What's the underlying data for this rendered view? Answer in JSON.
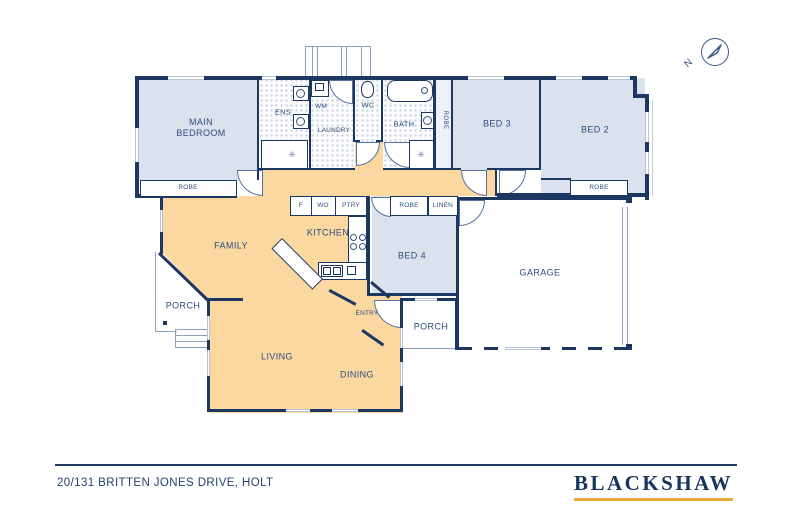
{
  "plan": {
    "compass": {
      "north_label": "N"
    },
    "rooms": {
      "main_bedroom": "MAIN BEDROOM",
      "ens": "ENS",
      "laundry": "LAUNDRY",
      "wm": "WM",
      "wc": "WC",
      "bath": "BATH",
      "bed2": "BED 2",
      "bed3": "BED 3",
      "bed4": "BED 4",
      "family": "FAMILY",
      "kitchen": "KITCHEN",
      "living": "LIVING",
      "dining": "DINING",
      "entry": "ENTRY",
      "garage": "GARAGE",
      "porch_left": "PORCH",
      "porch_right": "PORCH"
    },
    "storage": {
      "robe_main": "ROBE",
      "robe_bath_hall": "ROBE",
      "robe_bed2": "ROBE",
      "robe_bed4": "ROBE",
      "linen": "LINEN"
    },
    "kitchen_units": {
      "fridge": "F",
      "wall_oven": "WO",
      "pantry": "PTRY"
    },
    "icons": {
      "shower": "✳"
    }
  },
  "footer": {
    "address": "20/131 BRITTEN JONES DRIVE, HOLT",
    "brand": "BLACKSHAW"
  },
  "colors": {
    "wall_navy": "#1d3763",
    "room_blue": "#dce1ee",
    "floor_orange": "#fad8a0",
    "brand_gold": "#e8a63c"
  }
}
